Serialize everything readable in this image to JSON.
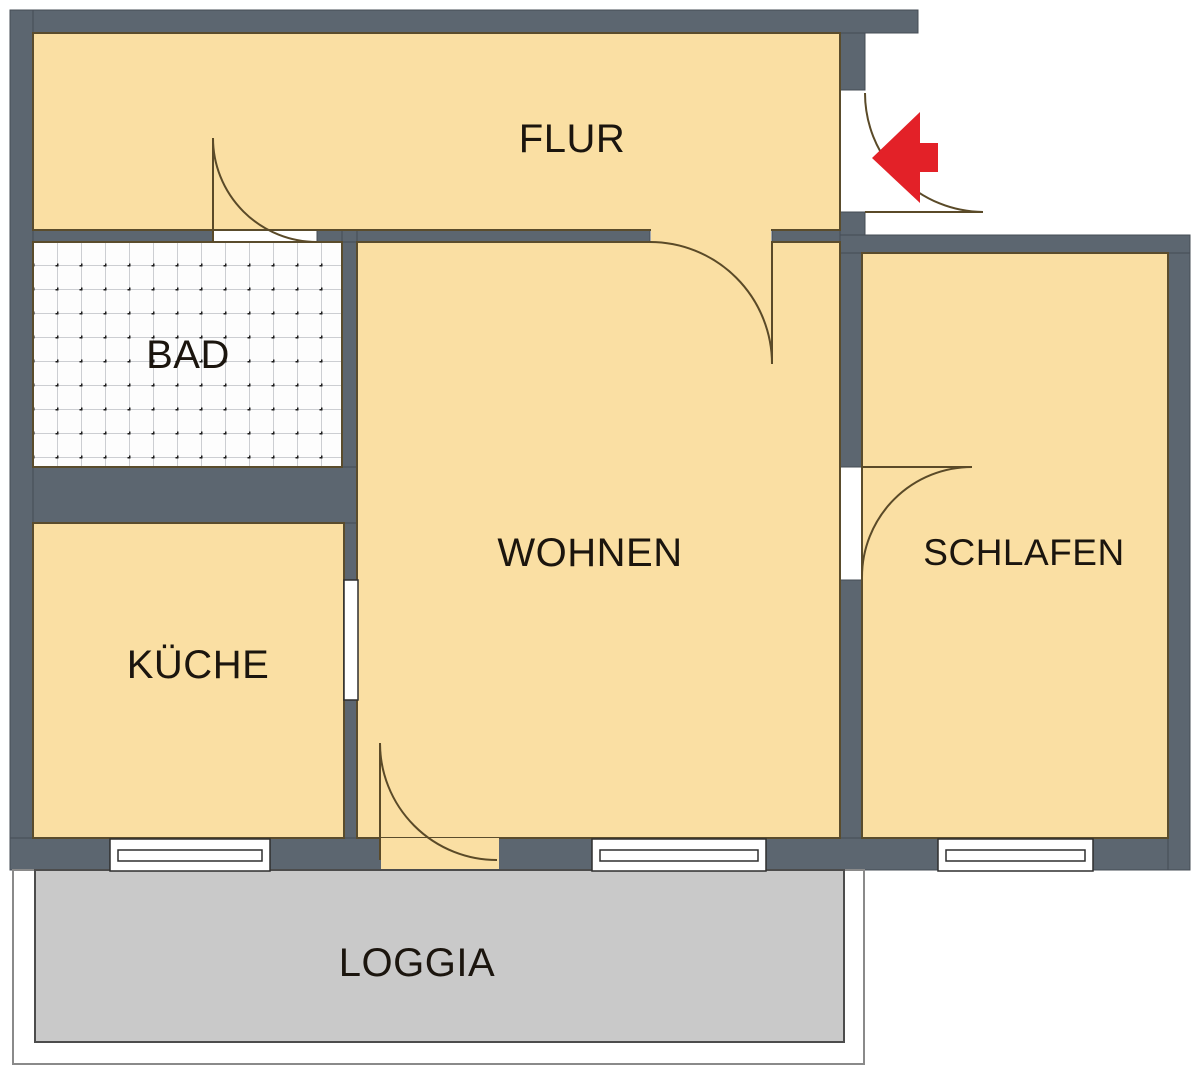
{
  "plan": {
    "title": "apartment floor plan",
    "rooms": [
      {
        "id": "flur",
        "label": "FLUR"
      },
      {
        "id": "bad",
        "label": "BAD"
      },
      {
        "id": "wohnen",
        "label": "WOHNEN"
      },
      {
        "id": "schlafen",
        "label": "SCHLAFEN"
      },
      {
        "id": "kueche",
        "label": "KÜCHE"
      },
      {
        "id": "loggia",
        "label": "LOGGIA"
      }
    ],
    "colors": {
      "wall": "#5c6670",
      "floor": "#fadfa3",
      "loggia_deck": "#c9c9c9",
      "entrance_arrow": "#e32128",
      "tile_background": "#fdfdfd",
      "tile_grid_line": "#9aa0a6",
      "tile_dot": "#1c1c1c",
      "outside": "#ffffff"
    },
    "icons": {
      "entrance_arrow": "red arrow pointing left through entry door",
      "door_arc": "quarter-circle door swing symbol",
      "window": "double-line window symbol"
    }
  }
}
